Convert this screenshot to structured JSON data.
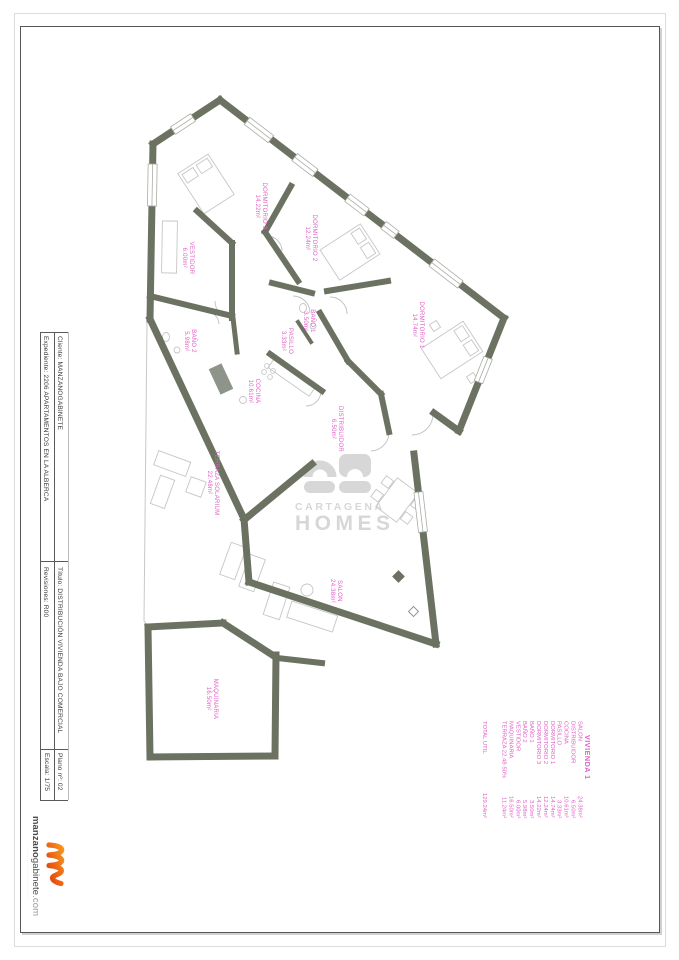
{
  "colors": {
    "wall": "#6c7261",
    "room_label_pink": "#e160c6",
    "watermark_gray": "#d7d7d7",
    "accent_orange": "#ec6b13"
  },
  "title_block": {
    "cliente": "Cliente: MANZANOGABINETE",
    "expediente": "Expediente: 2206 APARTAMENTOS EN LA ALBERCA",
    "titulo": "Título: DISTRIBUCIÓN VIVIENDA BAJO COMERCIAL",
    "revisiones": "Revisiones: R00",
    "plano": "Plano nº: 02",
    "escala": "Escala: 1/75"
  },
  "logo": {
    "brand_bold": "manzano",
    "brand_rest": "gabinete",
    "brand_tld": ".com",
    "tagline": "····························"
  },
  "watermark": {
    "line1": "CARTAGENA",
    "line2": "HOMES"
  },
  "legend": {
    "title": "VIVIENDA 1",
    "rows": [
      {
        "id": "salon",
        "label": "SALON",
        "value": "24.38m²"
      },
      {
        "id": "distribuidor",
        "label": "DISTRIBUIDOR",
        "value": "6.50m²"
      },
      {
        "id": "cocina",
        "label": "COCINA",
        "value": "10.61m²"
      },
      {
        "id": "pasillo",
        "label": "PASILLO",
        "value": "3.33m²"
      },
      {
        "id": "dormitorio1",
        "label": "DORMITORIO 1",
        "value": "14.74m²"
      },
      {
        "id": "dormitorio2",
        "label": "DORMITORIO 2",
        "value": "12.24m²"
      },
      {
        "id": "dormitorio3",
        "label": "DORMITORIO 3",
        "value": "14.22m²"
      },
      {
        "id": "bano1",
        "label": "BAÑO 1",
        "value": "3.50m²"
      },
      {
        "id": "bano2",
        "label": "BAÑO 2",
        "value": "5.98m²"
      },
      {
        "id": "vestidor",
        "label": "VESTIDOR",
        "value": "6.00m²"
      },
      {
        "id": "maquinaria",
        "label": "MAQUINARIA",
        "value": "16.50m²"
      },
      {
        "id": "terraza",
        "label": "TERRAZA 22.48·50%",
        "value": "11.24m²"
      }
    ],
    "total_label": "TOTAL UTIL",
    "total_value": "129.24m²"
  },
  "rooms": [
    {
      "id": "dormitorio3",
      "name": "DORMITORIO 3",
      "area": "14.22m²"
    },
    {
      "id": "dormitorio2",
      "name": "DORMITORIO 2",
      "area": "12.24m²"
    },
    {
      "id": "vestidor",
      "name": "VESTIDOR",
      "area": "6.00m²"
    },
    {
      "id": "bano1",
      "name": "BAÑO 1",
      "area": "3.50m²"
    },
    {
      "id": "pasillo",
      "name": "PASILLO",
      "area": "3.33m²"
    },
    {
      "id": "dormitorio1",
      "name": "DORMITORIO 1",
      "area": "14.74m²"
    },
    {
      "id": "bano2",
      "name": "BAÑO 2",
      "area": "5.98m²"
    },
    {
      "id": "cocina",
      "name": "COCINA",
      "area": "10.61m²"
    },
    {
      "id": "distribuidor",
      "name": "DISTRIBUIDOR",
      "area": "6.50m²"
    },
    {
      "id": "terraza",
      "name": "TERRAZA SOLARIUM",
      "area": "22.48m²"
    },
    {
      "id": "salon",
      "name": "SALON",
      "area": "24.38m²"
    },
    {
      "id": "maquinaria",
      "name": "MAQUINARIA",
      "area": "16.50m²"
    }
  ]
}
